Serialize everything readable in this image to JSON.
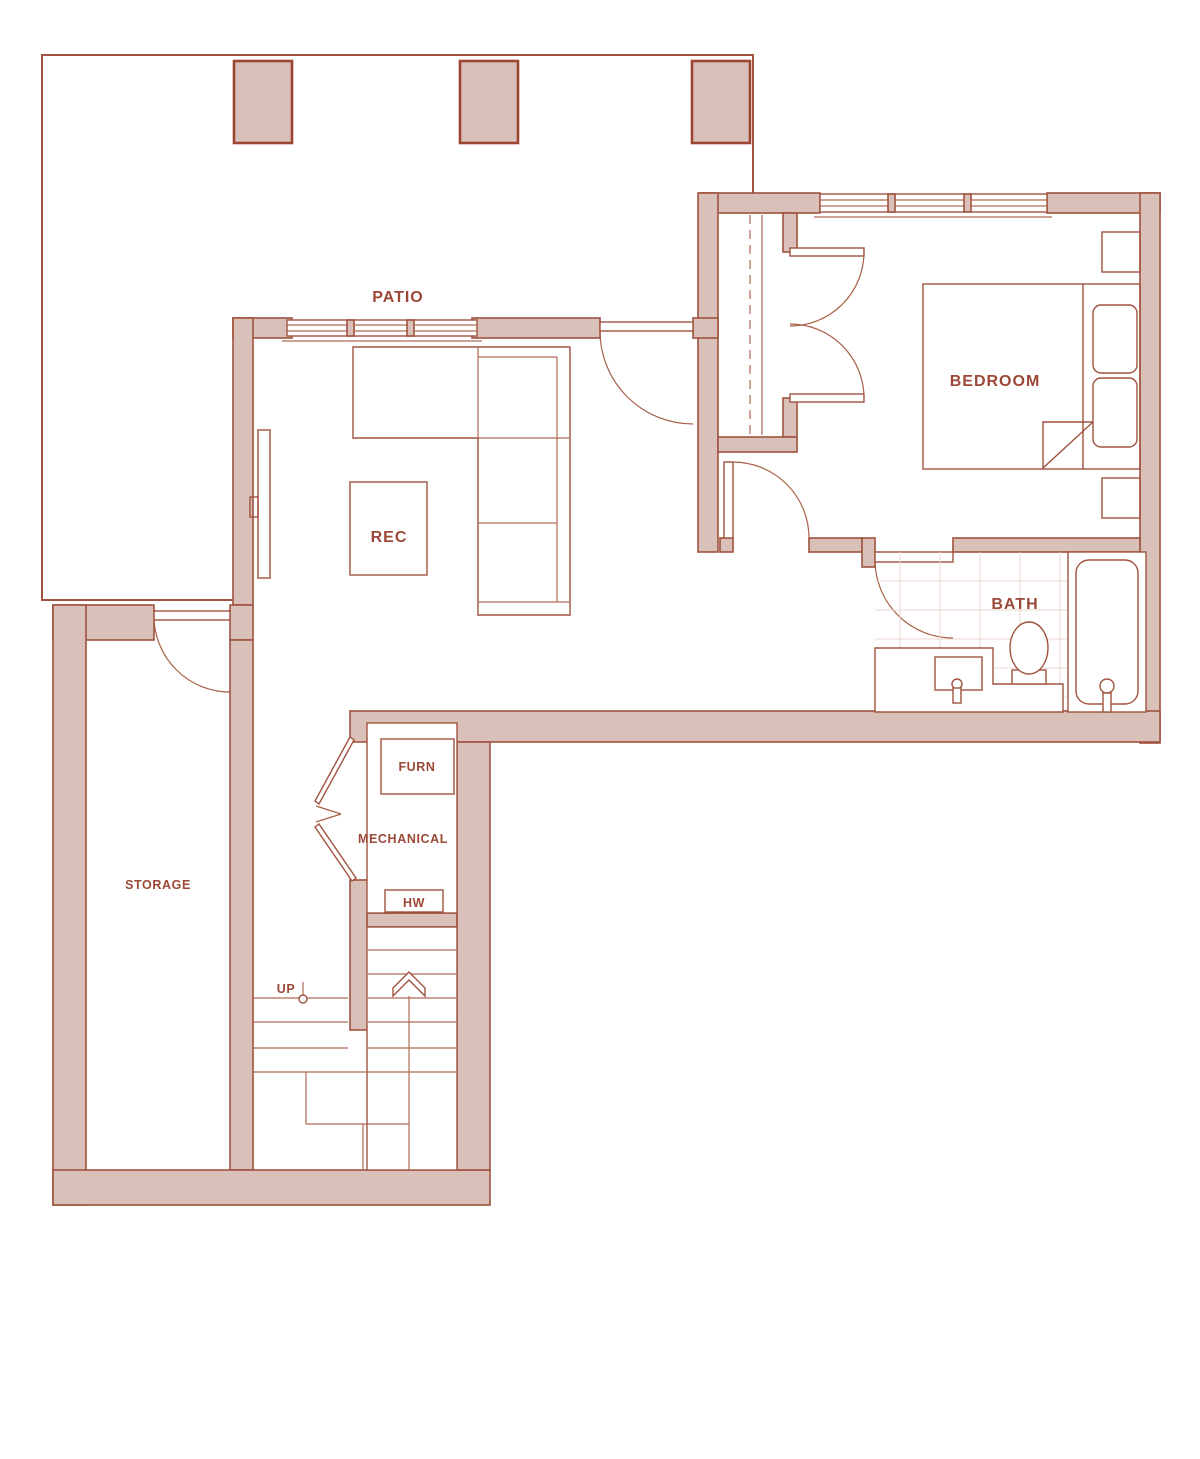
{
  "plan": {
    "title": "Basement floor plan",
    "rooms": {
      "patio": {
        "label": "PATIO"
      },
      "bedroom": {
        "label": "BEDROOM"
      },
      "rec": {
        "label": "REC"
      },
      "bath": {
        "label": "BATH"
      },
      "storage": {
        "label": "STORAGE"
      },
      "mechanical": {
        "label": "MECHANICAL"
      },
      "furnace": {
        "label": "FURN"
      },
      "hot_water": {
        "label": "HW"
      },
      "stairs": {
        "label": "UP"
      }
    },
    "colors": {
      "wall_fill": "#d9c1b9",
      "wall_line": "#a0523e",
      "label_text": "#9c4837",
      "tile_line": "#ead6cf",
      "background": "#ffffff"
    }
  }
}
